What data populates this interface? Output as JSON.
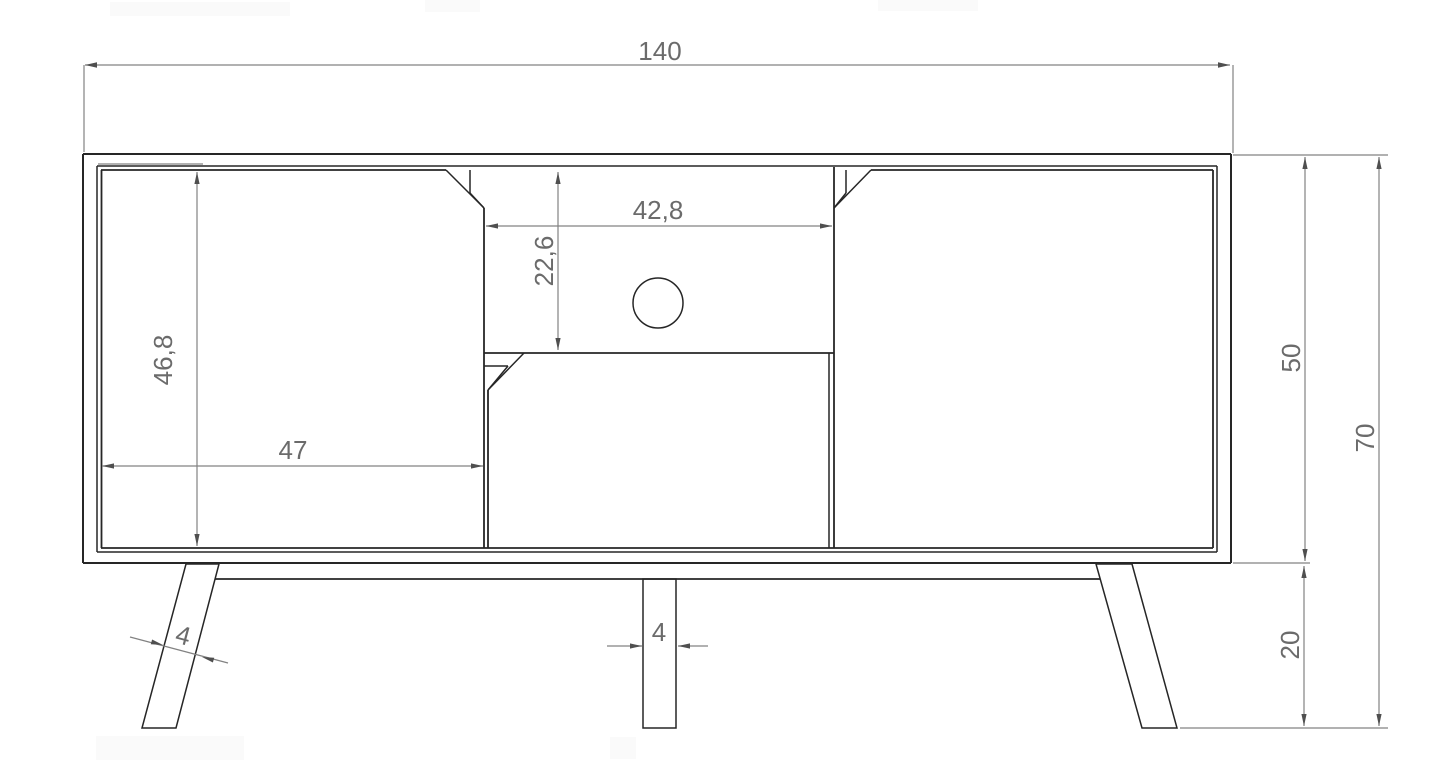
{
  "diagram": {
    "type": "furniture-technical-drawing-front-view",
    "dims": {
      "total_width": "140",
      "left_door_height": "46,8",
      "left_door_width": "47",
      "niche_width": "42,8",
      "niche_height": "22,6",
      "body_height": "50",
      "total_height": "70",
      "leg_height": "20",
      "left_leg_width": "4",
      "center_leg_width": "4"
    },
    "colors": {
      "outline": "#262626",
      "dimension_lines": "#828282",
      "dimension_text": "#6b6b6b",
      "background": "#ffffff"
    }
  }
}
